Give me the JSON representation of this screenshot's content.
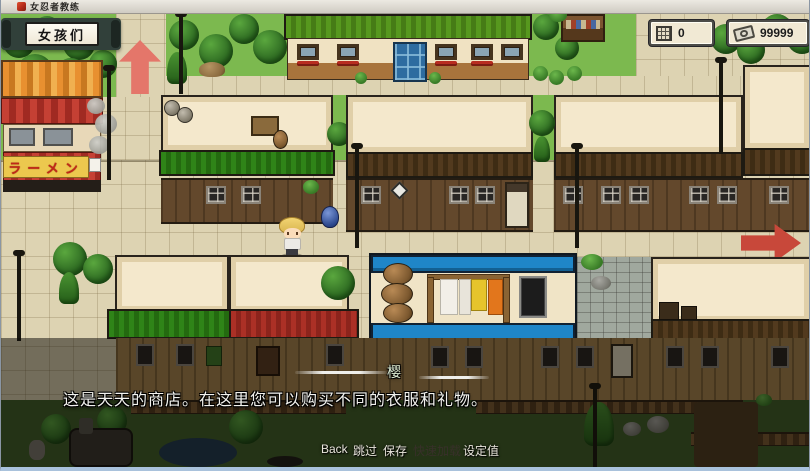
{
  "window": {
    "title": "女忍者教练"
  },
  "hud": {
    "girls_label": "女孩们",
    "counters": [
      {
        "icon": "grid-icon",
        "value": "0"
      },
      {
        "icon": "money-icon",
        "value": "99999"
      }
    ]
  },
  "map": {
    "ramen_sign": "ラーメン"
  },
  "dialog": {
    "speaker": "樱",
    "text": "这是天天的商店。在这里您可以购买不同的衣服和礼物。"
  },
  "menu": {
    "items": [
      {
        "label": "Back",
        "enabled": true
      },
      {
        "label": "跳过",
        "enabled": true
      },
      {
        "label": "保存",
        "enabled": true
      },
      {
        "label": "快速加载",
        "enabled": false
      },
      {
        "label": "设定值",
        "enabled": true
      }
    ]
  },
  "colors": {
    "arrow": "#c8483a",
    "hud_box_bg": "#f1e9d4",
    "menu_disabled": "#38302a"
  }
}
